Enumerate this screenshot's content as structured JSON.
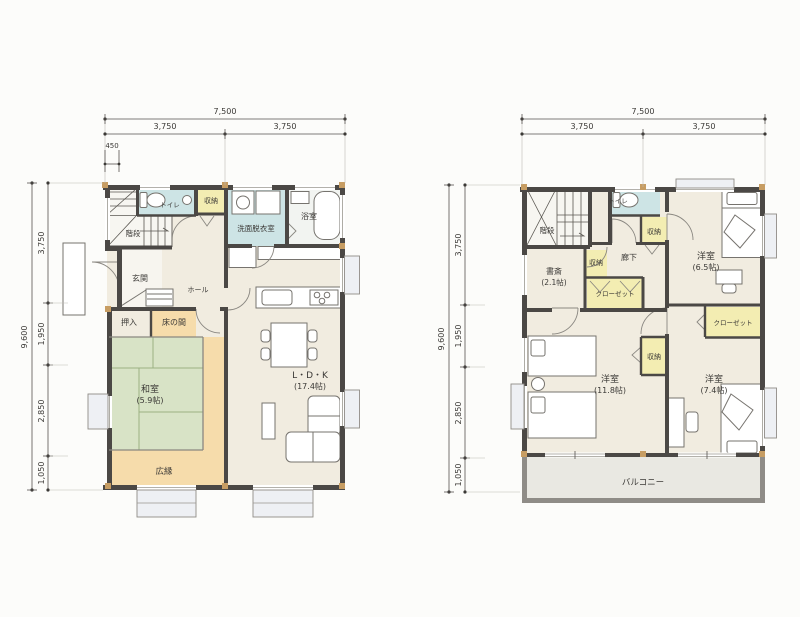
{
  "palette": {
    "wall": "#4b4845",
    "pillar": "#c79d63",
    "floor_cream": "#f1ece0",
    "floor_white": "#f7f6f1",
    "tatami_green": "#d8e3c6",
    "tatami_line": "#9bb083",
    "veranda_peach": "#f6dcab",
    "water_blue": "#cde4e5",
    "closet_yellow": "#f3edb2",
    "bath_white": "#f2f4f1",
    "balcony_floor": "#e9e8e2",
    "balcony_wall": "#8f8c87",
    "dim_text": "#3b3936"
  },
  "floor1": {
    "dims": {
      "top_total": "7,500",
      "top_left": "3,750",
      "top_right": "3,750",
      "offset": "450",
      "left_total": "9,600",
      "left_segments": [
        "3,750",
        "1,950",
        "2,850",
        "1,050"
      ]
    },
    "rooms": {
      "stairs": "階段",
      "toilet": "トイレ",
      "storage": "収納",
      "washroom": "洗面脱衣室",
      "bath": "浴室",
      "entrance": "玄関",
      "hall": "ホール",
      "oshiire": "押入",
      "tokonoma": "床の間",
      "washitsu": "和室",
      "washitsu_size": "(5.9帖)",
      "ldk": "L・D・K",
      "ldk_size": "(17.4帖)",
      "veranda": "広縁"
    }
  },
  "floor2": {
    "dims": {
      "top_total": "7,500",
      "top_left": "3,750",
      "top_right": "3,750",
      "left_total": "9,600",
      "left_segments": [
        "3,750",
        "1,950",
        "2,850",
        "1,050"
      ]
    },
    "rooms": {
      "stairs": "階段",
      "toilet": "トイレ",
      "storage_hall": "収納",
      "storage_study": "収納",
      "storage_center": "収納",
      "study": "書斎",
      "study_size": "(2.1帖)",
      "hallway": "廊下",
      "closet_left": "クローゼット",
      "closet_right": "クローゼット",
      "bedroom_ne": "洋室",
      "bedroom_ne_size": "(6.5帖)",
      "bedroom_sw": "洋室",
      "bedroom_sw_size": "(11.8帖)",
      "bedroom_se": "洋室",
      "bedroom_se_size": "(7.4帖)",
      "balcony": "バルコニー"
    }
  }
}
